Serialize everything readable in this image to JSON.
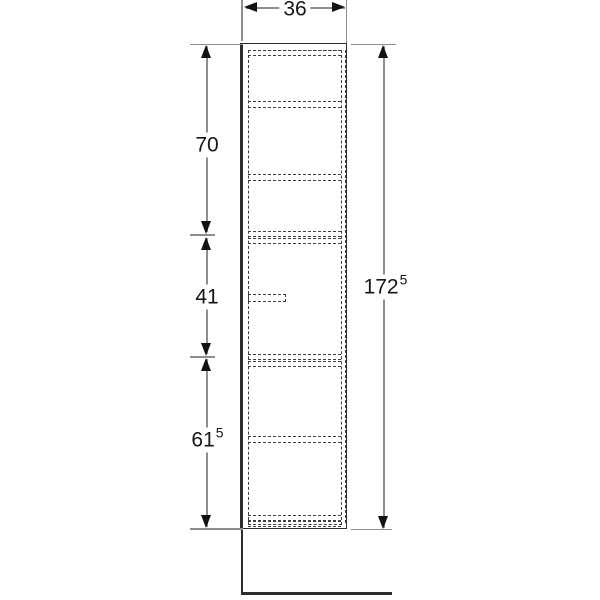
{
  "drawing": {
    "name": "tall-cabinet-side-elevation-dimension-drawing",
    "labels": {
      "width_top": {
        "main": "36",
        "sup": ""
      },
      "upper_section": {
        "main": "70",
        "sup": ""
      },
      "middle_section": {
        "main": "41",
        "sup": ""
      },
      "lower_section": {
        "main": "61",
        "sup": "5"
      },
      "total_height": {
        "main": "172",
        "sup": "5"
      }
    },
    "colors": {
      "outline": "#2d2d2d",
      "hidden_line": "#3f3f3f",
      "dimension_line": "#8e8e8e",
      "arrow": "#121212",
      "text": "#161616",
      "background": "#ffffff"
    }
  }
}
